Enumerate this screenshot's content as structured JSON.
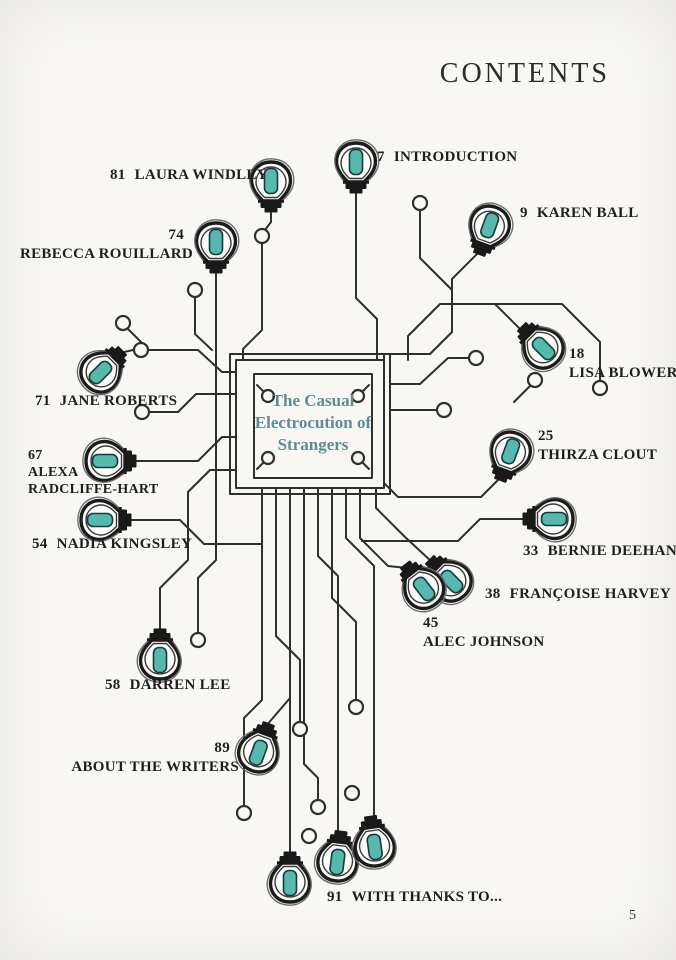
{
  "page": {
    "header": "CONTENTS",
    "page_number": "5",
    "center_title": {
      "line1": "The Casual",
      "line2": "Electrocution",
      "line3": "of Strangers"
    }
  },
  "entries": [
    {
      "num": "7",
      "label": "INTRODUCTION"
    },
    {
      "num": "81",
      "label": "LAURA WINDLEY"
    },
    {
      "num": "9",
      "label": "KAREN BALL"
    },
    {
      "num": "74",
      "label": "REBECCA ROUILLARD"
    },
    {
      "num": "18",
      "label": "LISA BLOWER"
    },
    {
      "num": "71",
      "label": "JANE ROBERTS"
    },
    {
      "num": "25",
      "label": "THIRZA CLOUT"
    },
    {
      "num": "67",
      "line1": "ALEXA",
      "line2": "RADCLIFFE-HART"
    },
    {
      "num": "54",
      "label": "NADIA KINGSLEY"
    },
    {
      "num": "33",
      "label": "BERNIE DEEHAN"
    },
    {
      "num": "38",
      "label": "FRANÇOISE HARVEY"
    },
    {
      "num": "45",
      "label": "ALEC JOHNSON"
    },
    {
      "num": "58",
      "label": "DARREN LEE"
    },
    {
      "num": "89",
      "label": "ABOUT THE WRITERS"
    },
    {
      "num": "91",
      "label": "WITH THANKS TO..."
    }
  ],
  "colors": {
    "background": "#f8f7f4",
    "wire": "#2f2f2f",
    "text": "#1e1e1e",
    "title_teal": "#5e8c95",
    "bulb_teal": "#57b9ae"
  }
}
